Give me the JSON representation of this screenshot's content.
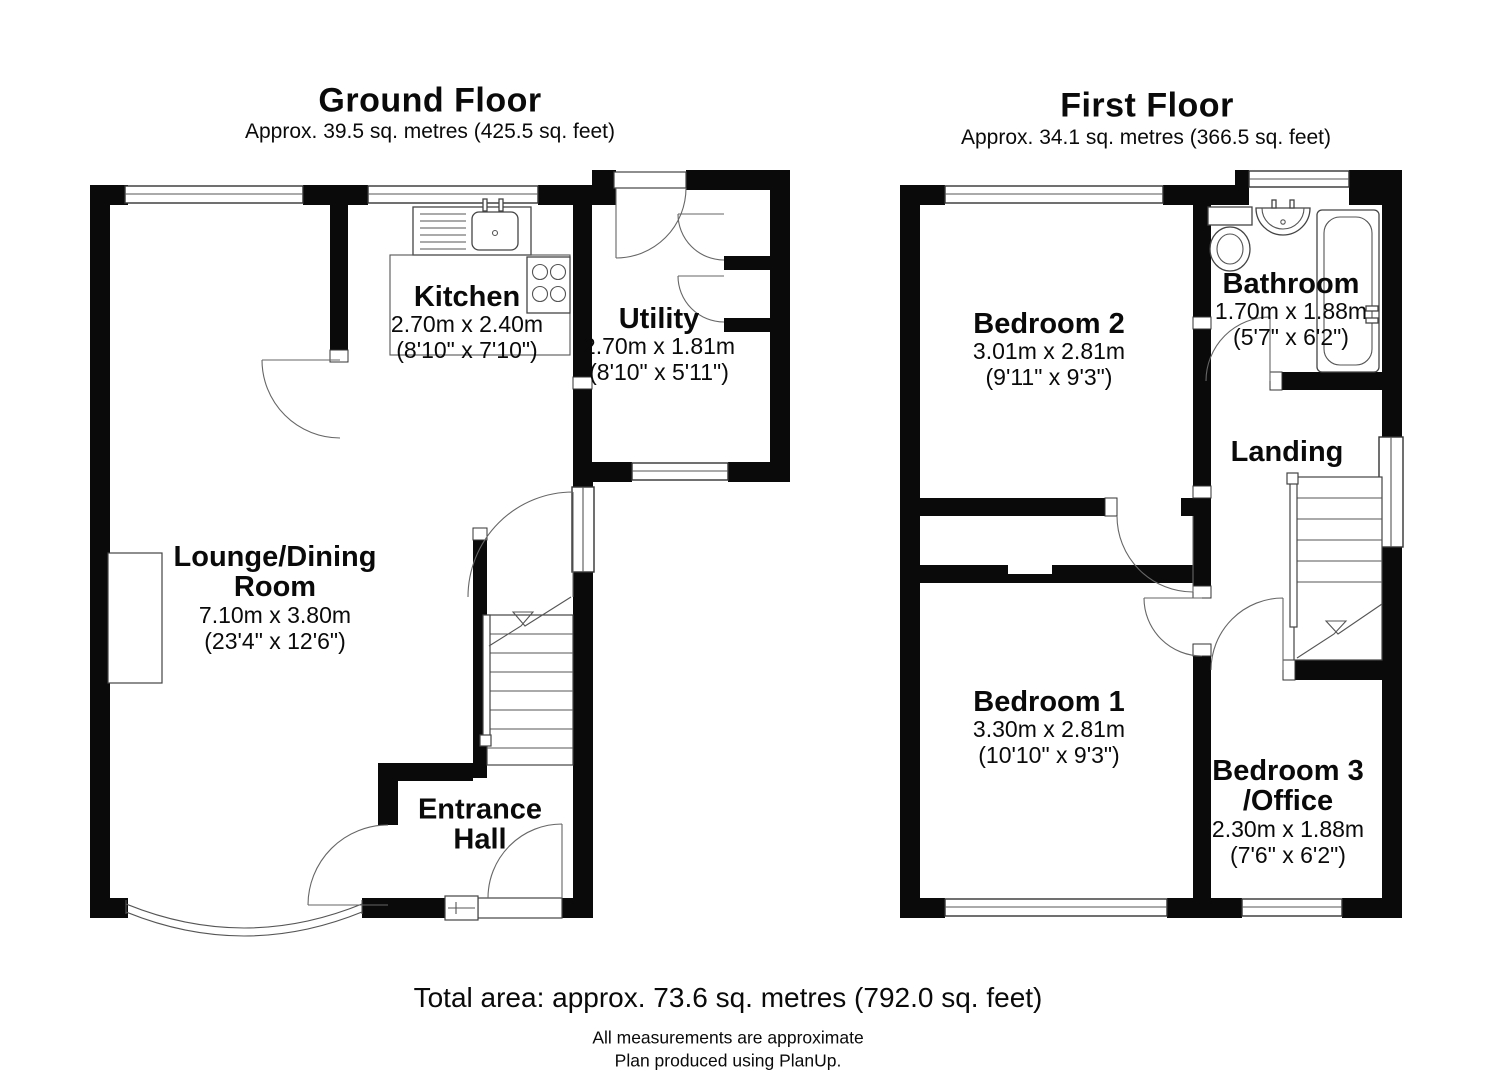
{
  "ground_floor": {
    "title": "Ground Floor",
    "subtitle": "Approx. 39.5 sq. metres (425.5 sq. feet)",
    "rooms": {
      "lounge": {
        "line1": "Lounge/Dining",
        "line2": "Room",
        "metric": "7.10m x 3.80m",
        "imperial": "(23'4\" x 12'6\")"
      },
      "kitchen": {
        "line1": "Kitchen",
        "metric": "2.70m x 2.40m",
        "imperial": "(8'10\" x 7'10\")"
      },
      "utility": {
        "line1": "Utility",
        "metric": "2.70m x 1.81m",
        "imperial": "(8'10\" x 5'11\")"
      },
      "entrance_hall": {
        "line1": "Entrance",
        "line2": "Hall"
      }
    }
  },
  "first_floor": {
    "title": "First Floor",
    "subtitle": "Approx. 34.1 sq. metres (366.5 sq. feet)",
    "rooms": {
      "bedroom2": {
        "line1": "Bedroom 2",
        "metric": "3.01m x 2.81m",
        "imperial": "(9'11\" x 9'3\")"
      },
      "bathroom": {
        "line1": "Bathroom",
        "metric": "1.70m x 1.88m",
        "imperial": "(5'7\" x 6'2\")"
      },
      "landing": {
        "line1": "Landing"
      },
      "bedroom1": {
        "line1": "Bedroom 1",
        "metric": "3.30m x 2.81m",
        "imperial": "(10'10\" x 9'3\")"
      },
      "bedroom3": {
        "line1": "Bedroom 3",
        "line2": "/Office",
        "metric": "2.30m x 1.88m",
        "imperial": "(7'6\" x 6'2\")"
      }
    }
  },
  "footer": {
    "total_area": "Total area: approx. 73.6 sq. metres (792.0 sq. feet)",
    "note_measurements": "All measurements are approximate",
    "note_produced": "Plan produced using PlanUp."
  }
}
